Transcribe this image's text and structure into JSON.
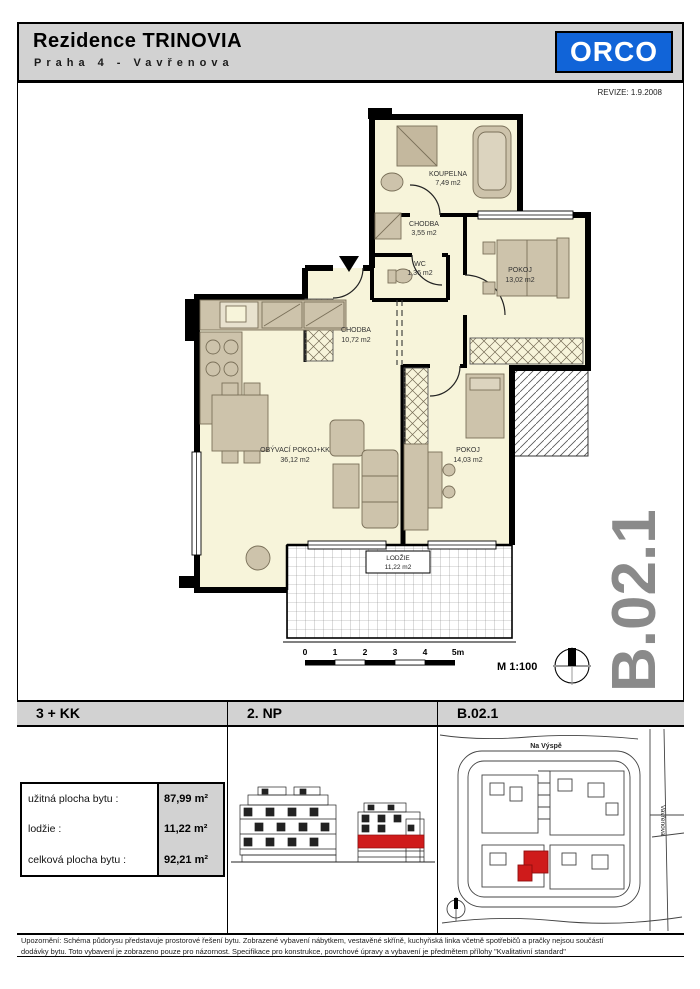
{
  "header": {
    "title": "Rezidence TRINOVIA",
    "subtitle": "Praha 4 - Vavřenova",
    "logo_text": "ORCO"
  },
  "revision": "REVIZE: 1.9.2008",
  "unit_code_large": "B.02.1",
  "plan": {
    "rooms": [
      {
        "name": "KOUPELNA",
        "area": "7,49 m2"
      },
      {
        "name": "CHODBA",
        "area": "3,55 m2"
      },
      {
        "name": "WC",
        "area": "1,36 m2"
      },
      {
        "name": "POKOJ",
        "area": "13,02 m2"
      },
      {
        "name": "CHODBA",
        "area": "10,72 m2"
      },
      {
        "name": "OBÝVACÍ POKOJ+KK",
        "area": "36,12 m2"
      },
      {
        "name": "POKOJ",
        "area": "14,03 m2"
      },
      {
        "name": "LODŽIE",
        "area": "11,22 m2"
      }
    ],
    "scale": {
      "ticks": [
        "0",
        "1",
        "2",
        "3",
        "4",
        "5m"
      ],
      "label": "M 1:100"
    }
  },
  "summary": {
    "disposition": "3 + KK",
    "floor": "2. NP",
    "unit": "B.02.1"
  },
  "area_table": {
    "rows": [
      {
        "label": "užitná plocha bytu :",
        "value": "87,99 m²"
      },
      {
        "label": "lodžie :",
        "value": "11,22 m²"
      },
      {
        "label": "celková plocha bytu :",
        "value": "92,21 m²"
      }
    ]
  },
  "site_plan": {
    "street_top": "Na Výspě",
    "street_right": "Vavřenova"
  },
  "disclaimer": {
    "line1": "Upozornění: Schéma půdorysu představuje prostorové řešení bytu. Zobrazené vybavení nábytkem, vestavěné skříně, kuchyňská linka včetně spotřebičů a pračky nejsou součástí",
    "line2": "dodávky bytu. Toto vybavení je zobrazeno pouze pro názornost. Specifikace pro konstrukce, povrchové úpravy a vybavení je předmětem přílohy \"Kvalitativní standard\""
  },
  "colors": {
    "logo_blue": "#1164d8",
    "highlight_red": "#cf1b1b",
    "unit_text_gray": "#8a8a8a",
    "room_fill": "#f7f4da",
    "furniture_fill": "#cdc3ab"
  }
}
